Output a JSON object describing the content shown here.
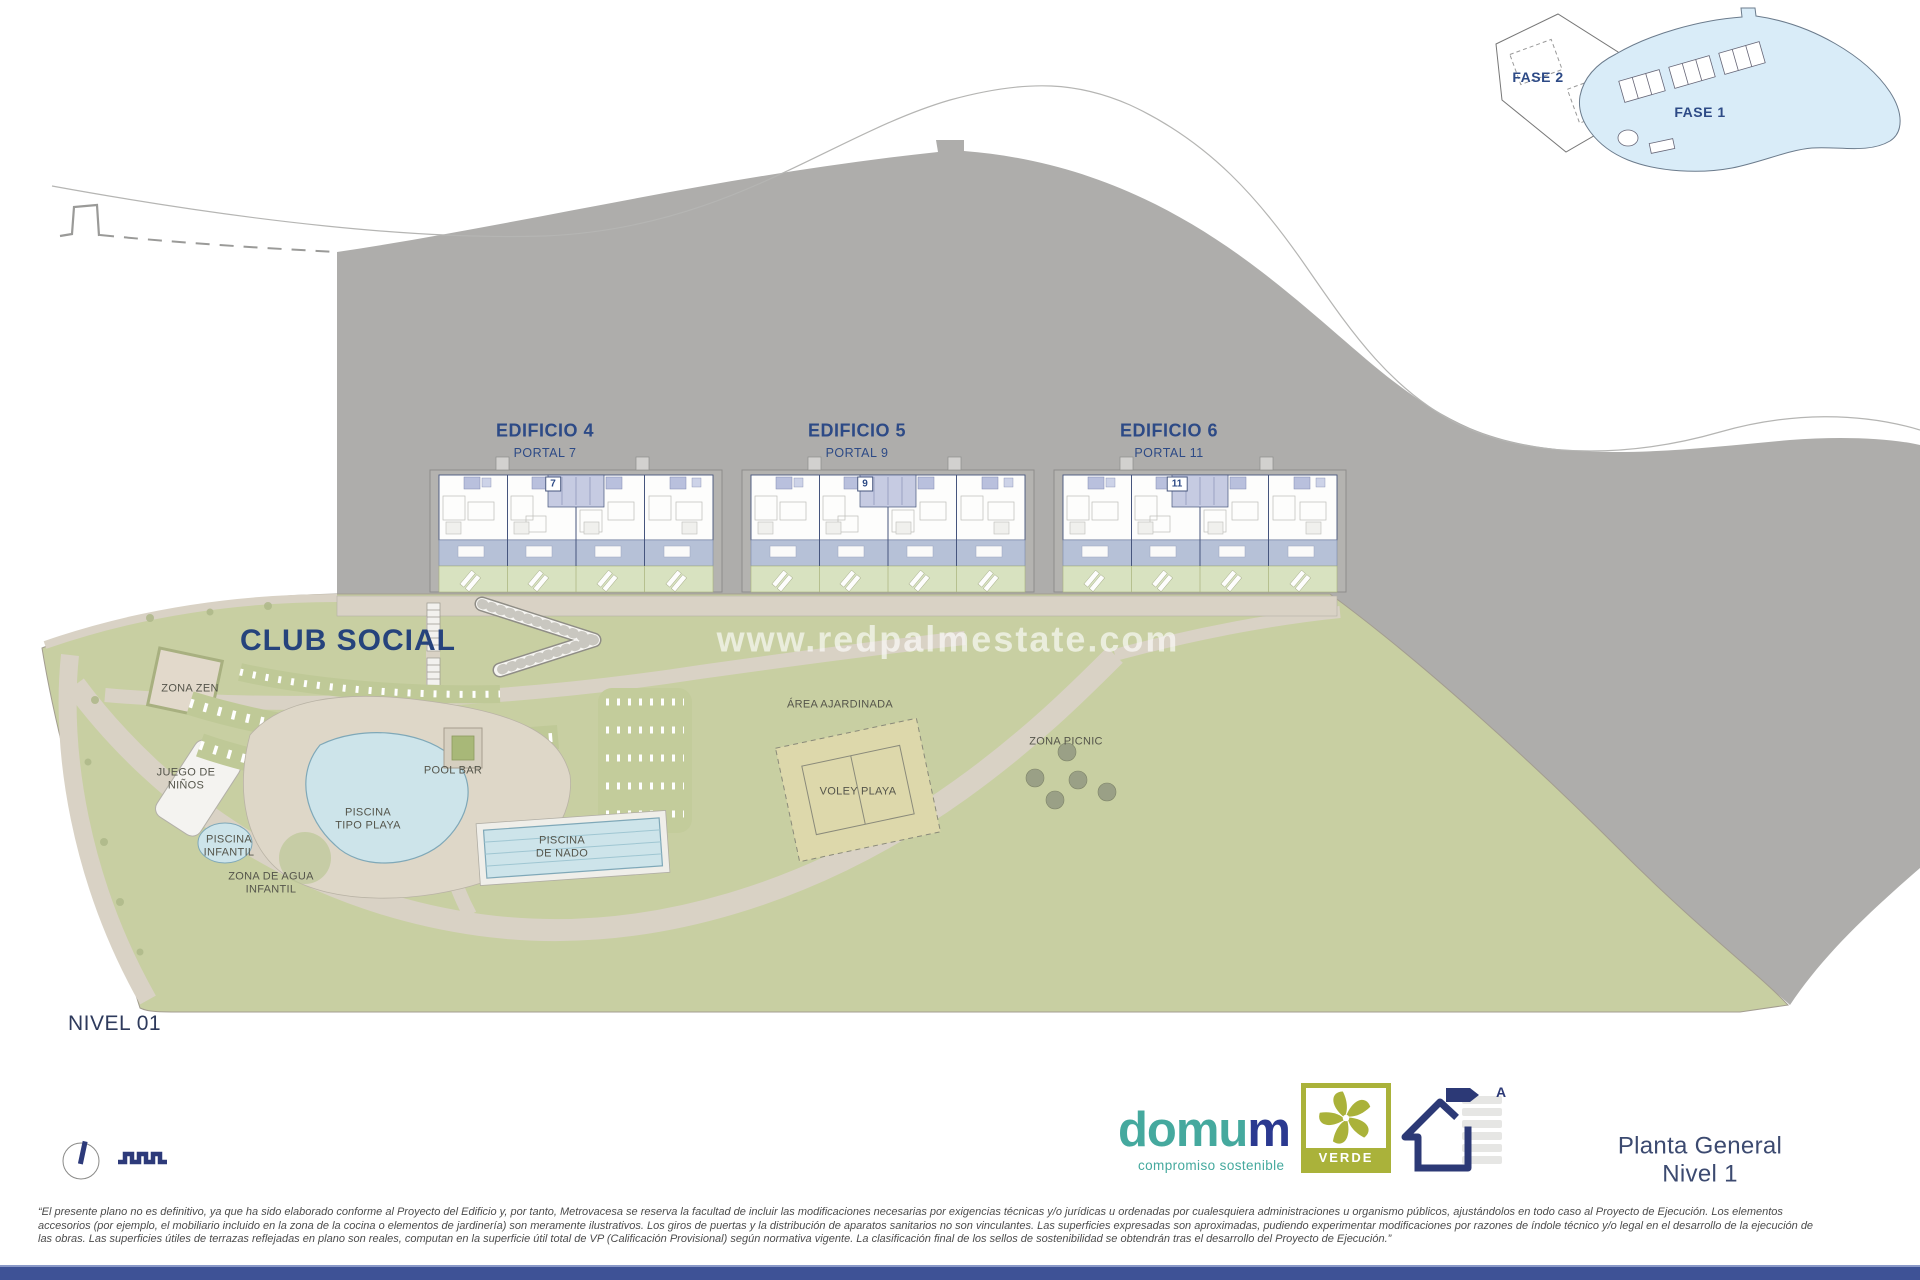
{
  "inset": {
    "fase1_label": "FASE 1",
    "fase2_label": "FASE 2"
  },
  "buildings": [
    {
      "name": "EDIFICIO 4",
      "portal": "PORTAL 7",
      "unit": "7"
    },
    {
      "name": "EDIFICIO 5",
      "portal": "PORTAL 9",
      "unit": "9"
    },
    {
      "name": "EDIFICIO 6",
      "portal": "PORTAL 11",
      "unit": "11"
    }
  ],
  "areas": {
    "club_social": "CLUB SOCIAL",
    "zona_zen": "ZONA ZEN",
    "juego_ninos": "JUEGO DE\nNIÑOS",
    "piscina_infantil": "PISCINA\nINFANTIL",
    "piscina_tipo_playa": "PISCINA\nTIPO PLAYA",
    "zona_agua_infantil": "ZONA DE AGUA\nINFANTIL",
    "pool_bar": "POOL BAR",
    "piscina_nado": "PISCINA\nDE NADO",
    "area_ajardinada": "ÁREA AJARDINADA",
    "voley_playa": "VOLEY PLAYA",
    "zona_picnic": "ZONA PICNIC"
  },
  "watermark": "www.redpalmestate.com",
  "level_label": "NIVEL 01",
  "sheet_title": "Planta General Nivel 1",
  "brand": {
    "name_main": "domu",
    "name_accent": "m",
    "tagline": "compromiso sostenible",
    "badge_label": "VERDE",
    "energy_rating": "A"
  },
  "disclaimer": {
    "line1": "“El presente plano no es definitivo, ya que ha sido elaborado conforme al Proyecto del Edificio y, por tanto, Metrovacesa se reserva la facultad de incluir las modificaciones necesarias por exigencias técnicas y/o jurídicas u ordenadas por cualesquiera administraciones u organismo públicos, ajustándolos en todo caso al Proyecto de Ejecución. Los elementos",
    "line2": "accesorios (por ejemplo, el mobiliario incluido en la zona de la cocina o elementos de jardinería) son meramente ilustrativos. Los giros de puertas y la distribución de aparatos sanitarios no son vinculantes. Las superficies expresadas son aproximadas, pudiendo experimentar modificaciones por razones de índole técnico y/o legal en el desarrollo de la ejecución de",
    "line3": "las obras. Las superficies útiles de terrazas reflejadas en plano son reales, computan en la superficie útil total de VP (Calificación Provisional) según normativa vigente. La clasificación final de los sellos de sostenibilidad se obtendrán tras el desarrollo del Proyecto de Ejecución.”"
  },
  "colors": {
    "terrain_gray": "#aeadab",
    "lawn_green": "#c8cfa2",
    "path_beige": "#d9d2c5",
    "sand": "#ded7c8",
    "pool_water": "#cde4ea",
    "navy_text": "#2d4a86",
    "brand_teal": "#45a99e",
    "brand_navy": "#2b3990",
    "badge_olive": "#aab23a",
    "inset_blue": "#d9ecf8",
    "footer_bar": "#3e5296"
  }
}
